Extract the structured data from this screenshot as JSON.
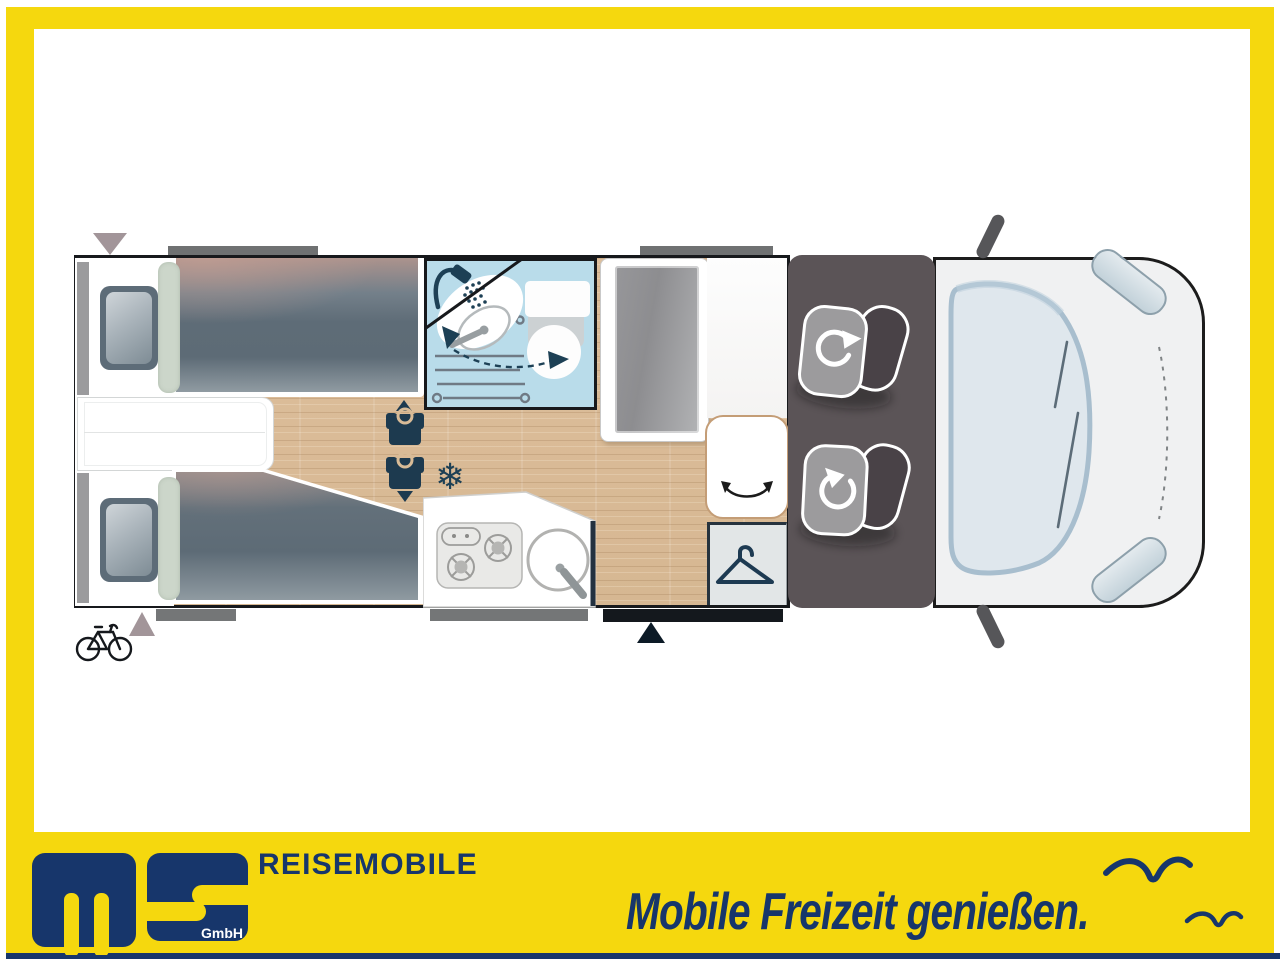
{
  "banner": {
    "title": "REISEMOBILE",
    "tagline": "Mobile Freizeit genießen.",
    "logo": {
      "company_suffix": "GmbH"
    },
    "colors": {
      "yellow": "#F5D80E",
      "navy": "#17366B"
    }
  },
  "floorplan": {
    "snowflake_char": "❄",
    "colors": {
      "bathroom_blue": "#B9DCEA",
      "wood": "#DEBF9C",
      "icon_navy": "#1D4055",
      "bed_slate": "#5E6C77",
      "cab_gray": "#5B5457"
    },
    "icons": [
      "shower-icon",
      "washbasin-icon",
      "toilet-icon",
      "radiator-icon",
      "swivel-arrow-icon",
      "heater-vent-icon",
      "snowflake-icon",
      "hob-icon",
      "sink-icon",
      "hanger-icon",
      "bench-swivel-icon",
      "swivel-seat-icon",
      "bicycle-icon",
      "entry-arrow-icon",
      "door-arrow-icon"
    ]
  }
}
